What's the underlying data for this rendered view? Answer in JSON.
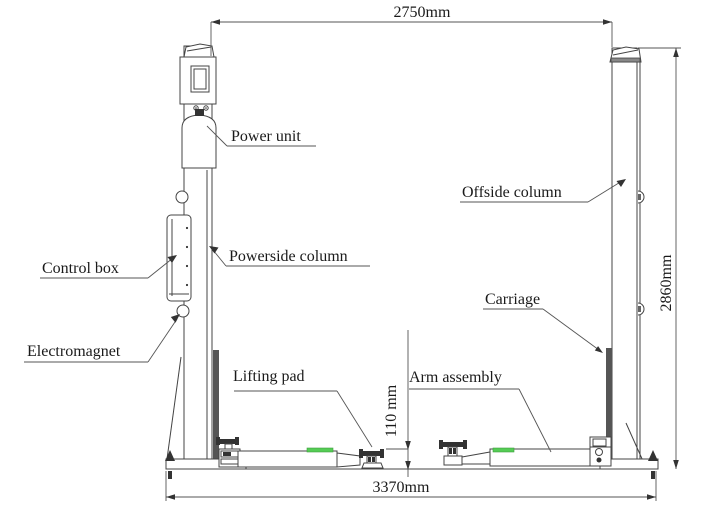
{
  "diagram": {
    "labels": {
      "power_unit": "Power unit",
      "offside_column": "Offside column",
      "control_box": "Control box",
      "powerside_column": "Powerside column",
      "electromagnet": "Electromagnet",
      "carriage": "Carriage",
      "lifting_pad": "Lifting pad",
      "arm_assembly": "Arm assembly"
    },
    "dimensions": {
      "overall_width_top": "2750mm",
      "overall_height": "2860mm",
      "base_width": "3370mm",
      "min_pad_height": "110 mm"
    },
    "colors": {
      "line": "#444444",
      "text": "#1a1a1a",
      "accent_green": "#55cc55",
      "background": "#ffffff"
    }
  }
}
